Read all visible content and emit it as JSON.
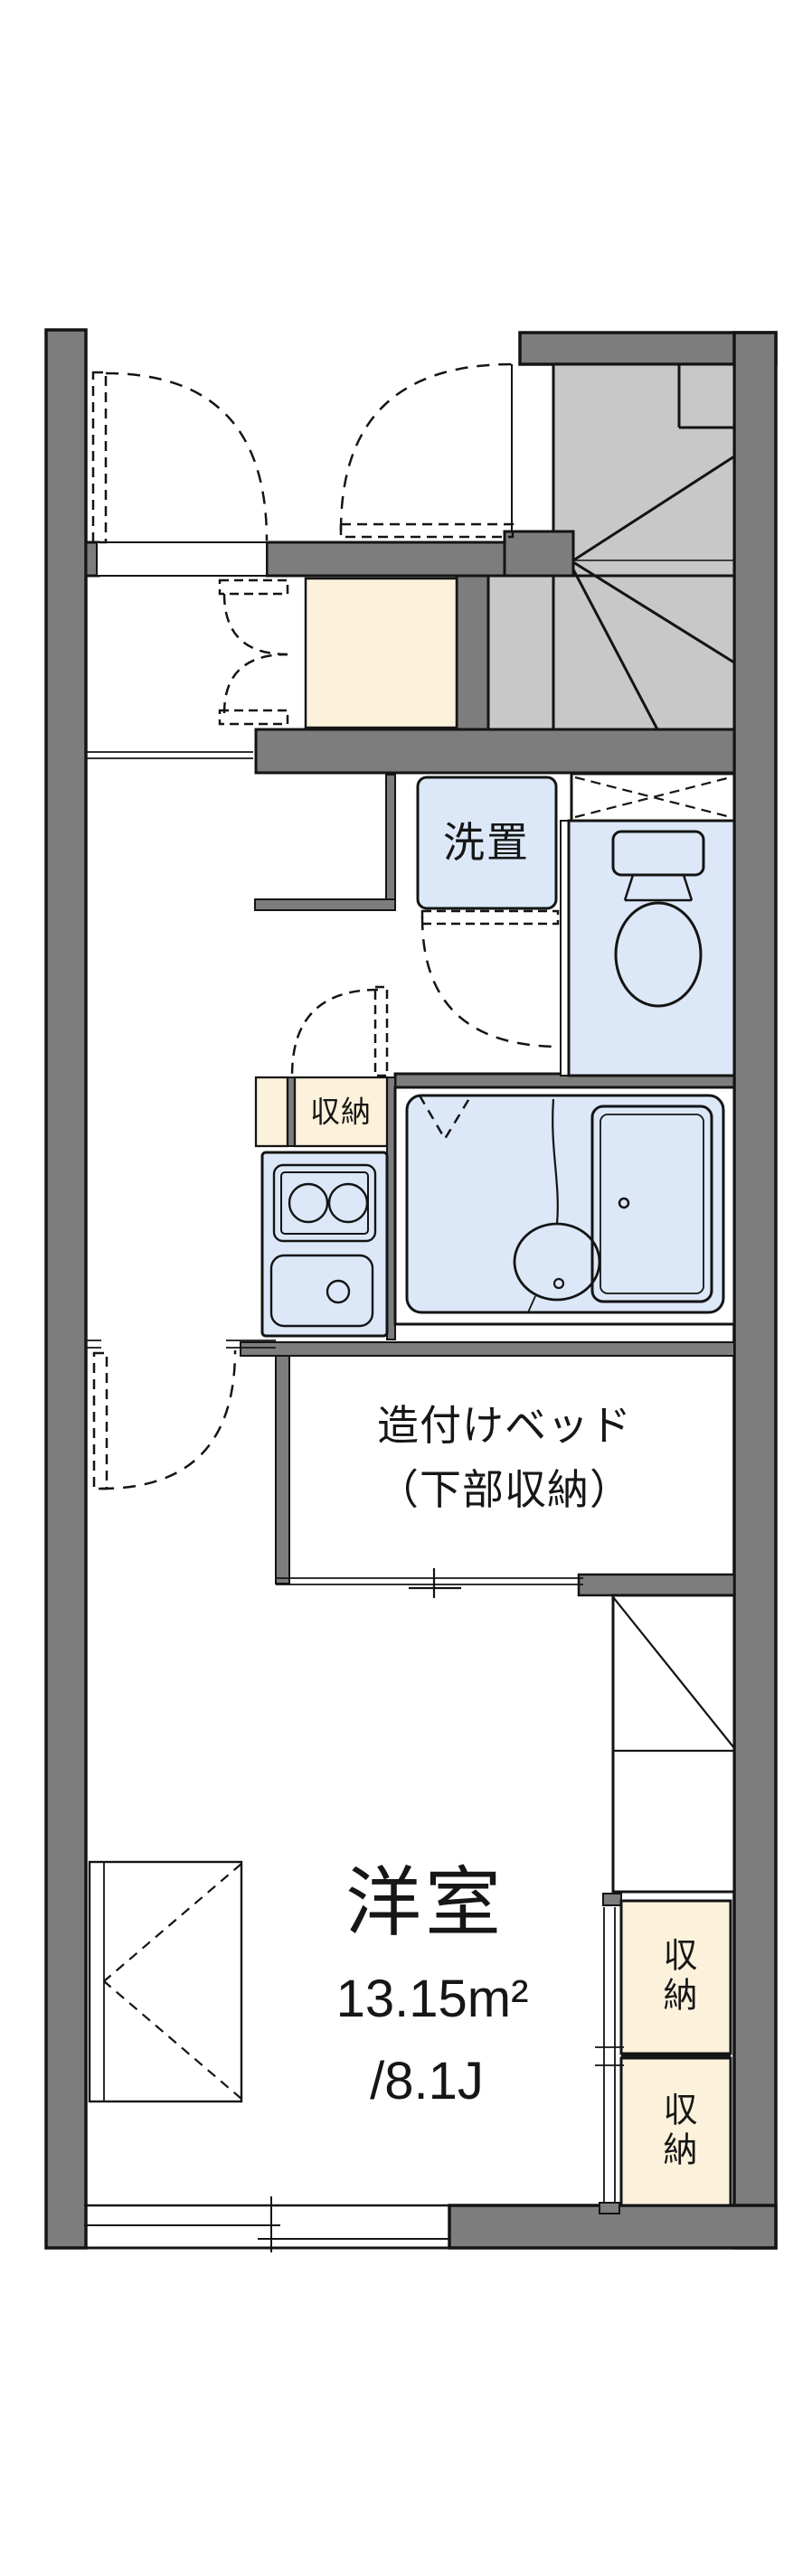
{
  "floorplan": {
    "laundry": {
      "label": "洗置"
    },
    "kitchen_storage": {
      "label": "収納"
    },
    "built_in_bed": {
      "label_line1": "造付けベッド",
      "label_line2": "（下部収納）"
    },
    "western_room": {
      "label": "洋室",
      "area_m2": "13.15m²",
      "area_jo": "/8.1J"
    },
    "storage_upper": {
      "label": "収納"
    },
    "storage_lower": {
      "label": "収納"
    },
    "colors": {
      "wall": "#7d7d7d",
      "stairs": "#c8c8c8",
      "wet_area_blue": "#dce8f8",
      "storage_cream": "#fcf2dc",
      "line": "#141414"
    }
  }
}
